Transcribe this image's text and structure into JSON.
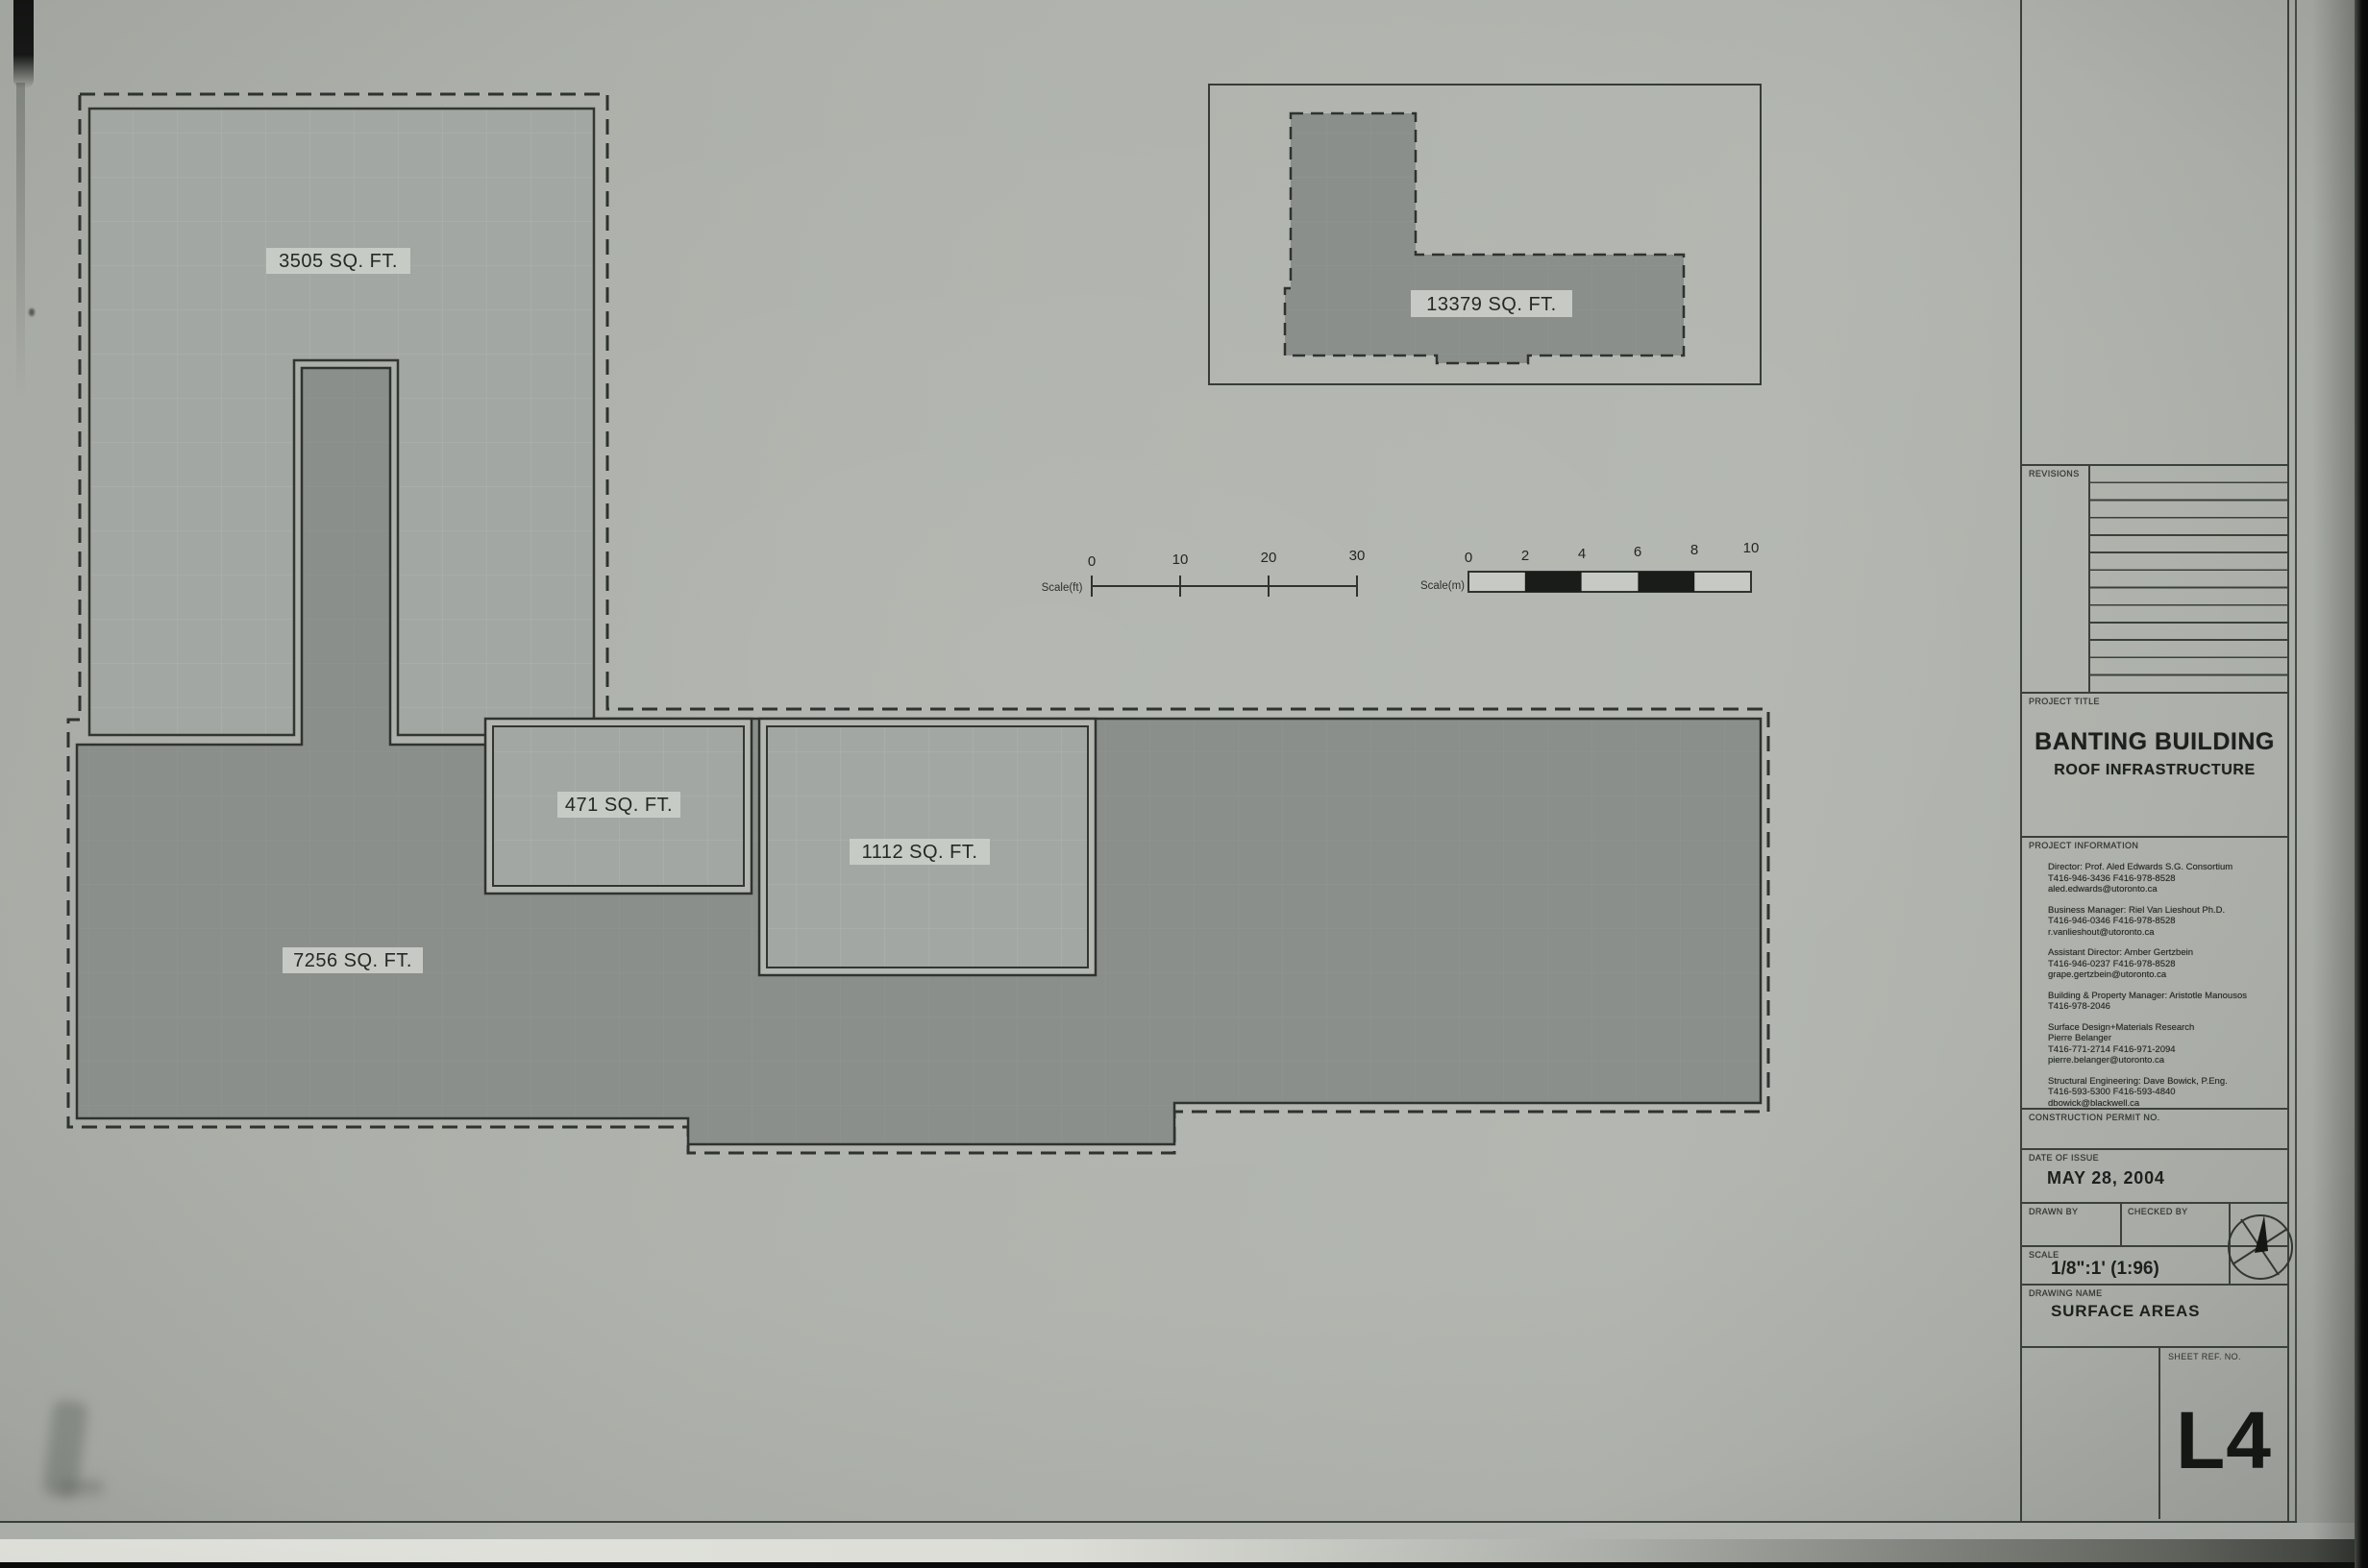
{
  "plan": {
    "areas": [
      {
        "name": "upper-roof",
        "label": "3505 SQ. FT."
      },
      {
        "name": "adjacent-building",
        "label": "13379 SQ. FT."
      },
      {
        "name": "small-roof",
        "label": "471 SQ. FT."
      },
      {
        "name": "mid-roof",
        "label": "1112 SQ. FT."
      },
      {
        "name": "main-roof",
        "label": "7256 SQ. FT."
      }
    ],
    "scale_ft": {
      "label": "Scale(ft)",
      "ticks": [
        "0",
        "10",
        "20",
        "30"
      ]
    },
    "scale_m": {
      "label": "Scale(m)",
      "ticks": [
        "0",
        "2",
        "4",
        "6",
        "8",
        "10"
      ]
    }
  },
  "title_block": {
    "revisions_label": "REVISIONS",
    "project_title_label": "PROJECT TITLE",
    "project_title": "BANTING BUILDING",
    "project_subtitle": "ROOF INFRASTRUCTURE",
    "project_information_label": "PROJECT INFORMATION",
    "contacts": [
      "Director: Prof. Aled Edwards S.G. Consortium\nT416-946-3436  F416-978-8528\naled.edwards@utoronto.ca",
      "Business Manager: Riel Van Lieshout Ph.D.\nT416-946-0346  F416-978-8528\nr.vanlieshout@utoronto.ca",
      "Assistant Director: Amber Gertzbein\nT416-946-0237  F416-978-8528\ngrape.gertzbein@utoronto.ca",
      "Building & Property Manager: Aristotle Manousos\nT416-978-2046",
      "Surface Design+Materials Research\nPierre Belanger\nT416-771-2714  F416-971-2094\npierre.belanger@utoronto.ca",
      "Structural Engineering: Dave Bowick, P.Eng.\nT416-593-5300  F416-593-4840\ndbowick@blackwell.ca"
    ],
    "construction_permit_label": "CONSTRUCTION PERMIT NO.",
    "date_of_issue_label": "DATE OF ISSUE",
    "date_of_issue": "MAY 28, 2004",
    "drawn_by_label": "DRAWN BY",
    "checked_by_label": "CHECKED BY",
    "scale_label": "SCALE",
    "scale_value": "1/8\":1' (1:96)",
    "drawing_name_label": "DRAWING NAME",
    "sheet_name": "SURFACE AREAS",
    "sheet_ref_label": "SHEET REF.  NO.",
    "sheet_ref": "L4"
  },
  "colors": {
    "paper": "#aeb1ab",
    "fill_light": "#a3a7a3",
    "fill_dark": "#8a8f8c",
    "line": "#3a403b",
    "label_bg": "#c9ccc7"
  }
}
